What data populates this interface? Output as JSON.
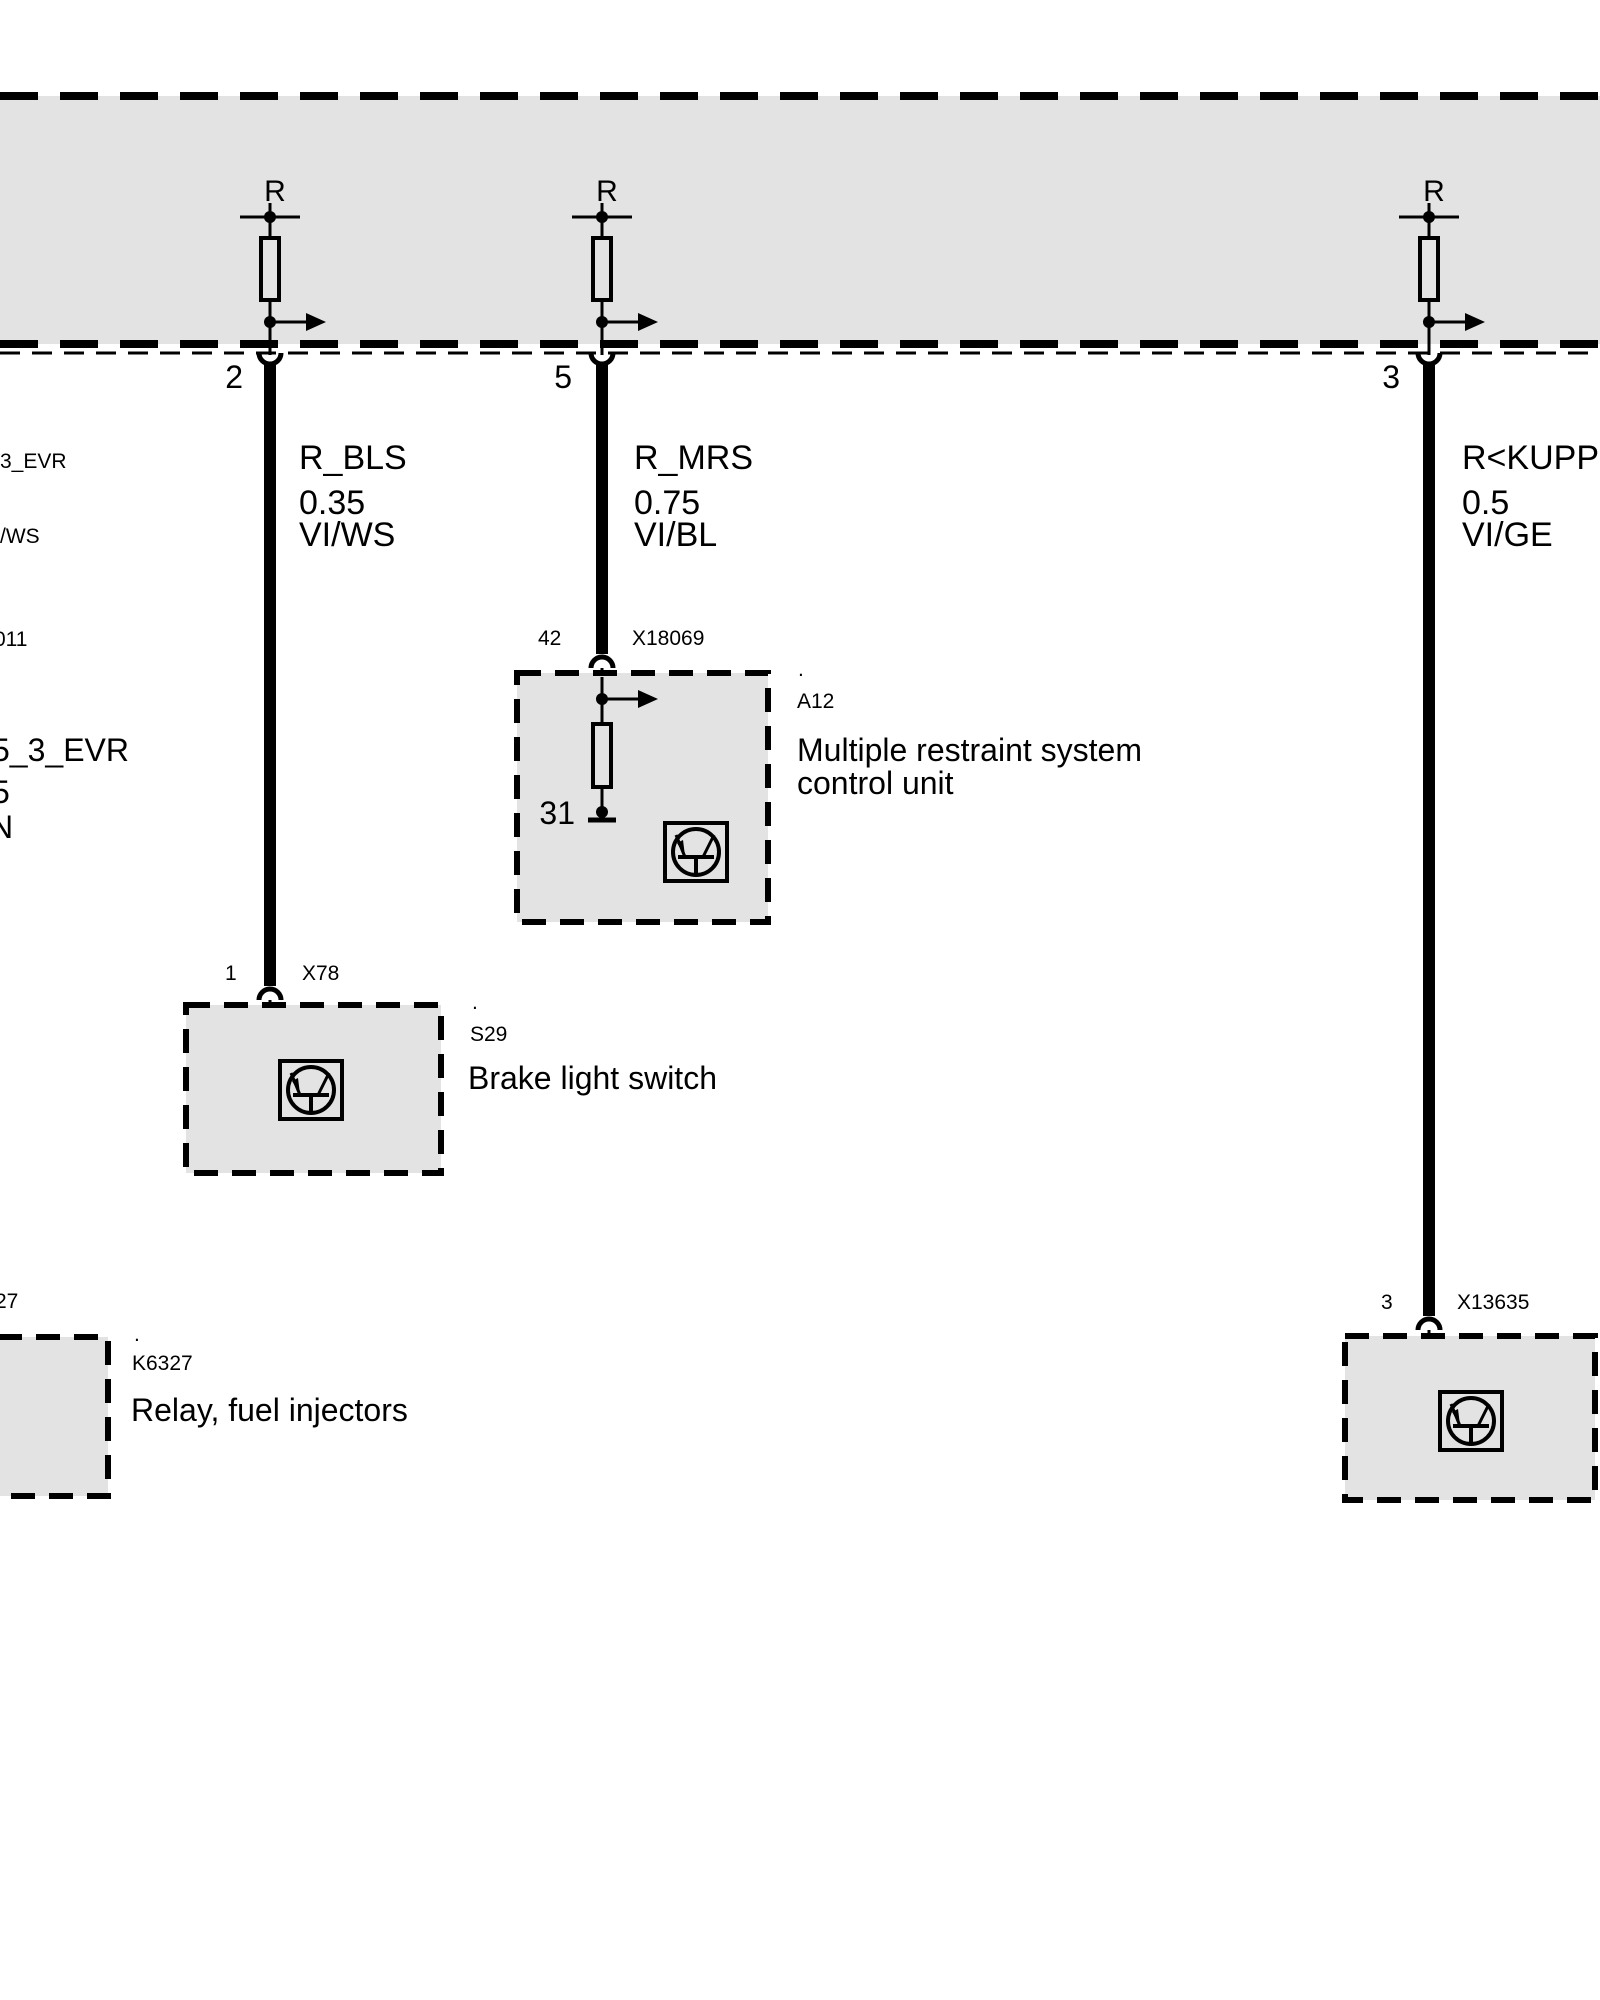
{
  "bus": {
    "r_label": "R"
  },
  "wires": [
    {
      "pin": "2",
      "name": "R_BLS",
      "size": "0.35",
      "color": "VI/WS"
    },
    {
      "pin": "5",
      "name": "R_MRS",
      "size": "0.75",
      "color": "VI/BL"
    },
    {
      "pin": "3",
      "name": "R<KUPPL",
      "size": "0.5",
      "color": "VI/GE"
    }
  ],
  "connectors": [
    {
      "pin": "42",
      "id": "X18069"
    },
    {
      "pin": "1",
      "id": "X78"
    },
    {
      "pin": "3",
      "id": "X13635"
    }
  ],
  "components": [
    {
      "dot": ".",
      "ref": "A12",
      "lines": [
        "Multiple restraint system",
        "control unit"
      ],
      "internal_pin": "31"
    },
    {
      "dot": ".",
      "ref": "S29",
      "lines": [
        "Brake light switch"
      ]
    },
    {
      "dot": ".",
      "ref": "K6327",
      "lines": [
        "Relay, fuel injectors"
      ]
    }
  ],
  "edge_fragments": [
    "3_EVR",
    "/WS",
    "011",
    "5_3_EVR",
    "5",
    "N",
    "27"
  ],
  "colors": {
    "bus_fill": "#e3e3e3",
    "line": "#000000",
    "background": "#ffffff"
  }
}
